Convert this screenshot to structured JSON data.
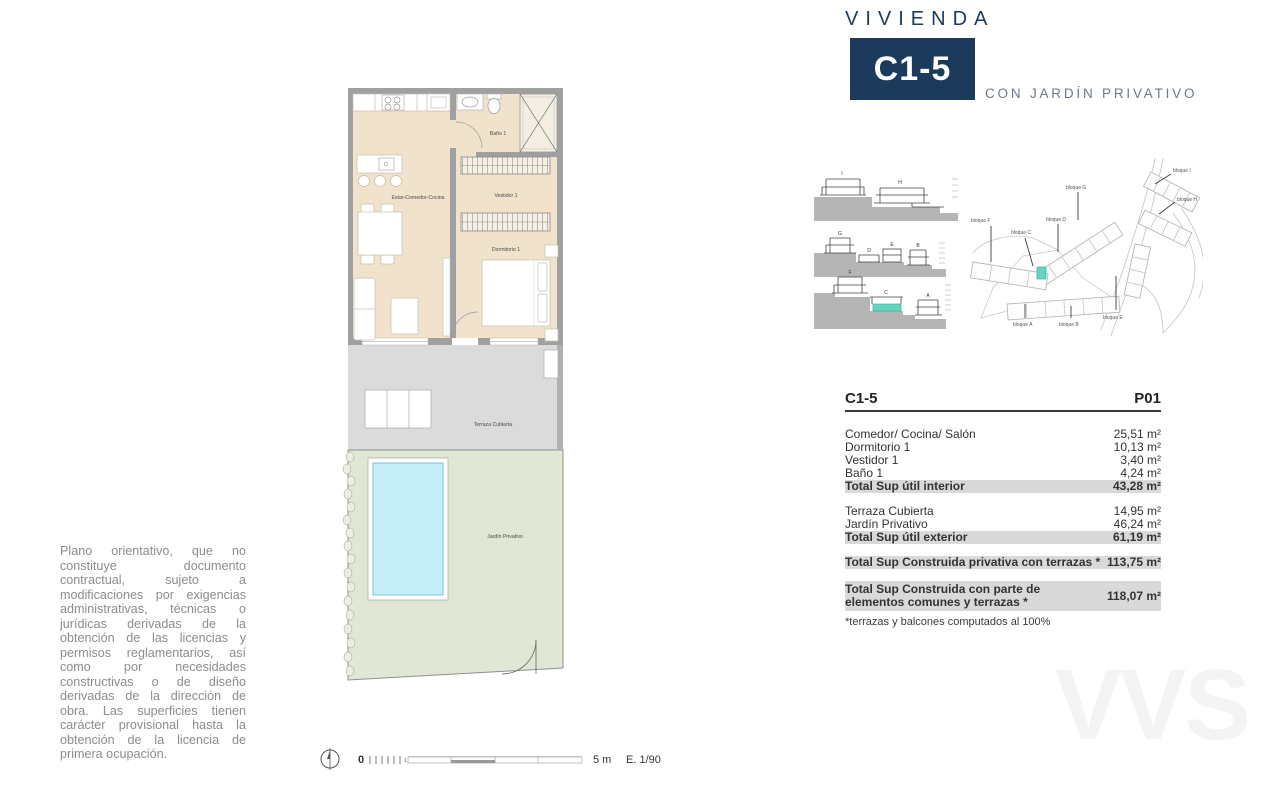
{
  "header": {
    "kicker": "VIVIENDA",
    "unit": "C1-5",
    "subtitle": "CON JARDÍN PRIVATIVO"
  },
  "plan": {
    "labels": {
      "estar": "Estar-Comedor-Cocina",
      "bano": "Baño 1",
      "vestidor": "Vestidor 1",
      "dormitorio": "Dormitorio 1",
      "terraza": "Terraza Cubierta",
      "jardin": "Jardín Privativo"
    }
  },
  "sections": {
    "blocks": {
      "i": "I",
      "h": "H",
      "g": "G",
      "d": "D",
      "e": "E",
      "b": "B",
      "f": "F",
      "c": "C",
      "a": "A"
    },
    "highlight_block": "C"
  },
  "siteplan": {
    "labels": {
      "f": "bloque F",
      "c": "bloque C",
      "g": "bloque G",
      "d": "bloque D",
      "i": "bloque I",
      "h": "bloque H",
      "a": "bloque A",
      "b": "bloque B",
      "e": "bloque E"
    }
  },
  "table": {
    "unit": "C1-5",
    "floor": "P01",
    "rows": [
      {
        "label": "Comedor/ Cocina/ Salón",
        "value": "25,51 m²"
      },
      {
        "label": "Dormitorio 1",
        "value": "10,13 m²"
      },
      {
        "label": "Vestidor 1",
        "value": "3,40 m²"
      },
      {
        "label": "Baño 1",
        "value": "4,24 m²"
      },
      {
        "label": "Total Sup útil interior",
        "value": "43,28 m²"
      },
      {
        "label": "Terraza Cubierta",
        "value": "14,95 m²"
      },
      {
        "label": "Jardín Privativo",
        "value": "46,24 m²"
      },
      {
        "label": "Total Sup útil exterior",
        "value": "61,19 m²"
      },
      {
        "label": "Total Sup Construida privativa con terrazas *",
        "value": "113,75 m²"
      },
      {
        "label": "Total Sup Construida con parte de elementos comunes y terrazas *",
        "value": "118,07 m²"
      }
    ],
    "footnote": "*terrazas y balcones computados al 100%"
  },
  "disclaimer": "Plano orientativo, que no constituye documento contractual, sujeto a modificaciones por exigencias administrativas, técnicas o jurídicas derivadas de la obtención de las licencias y permisos reglamentarios, así como por necesidades constructivas o de diseño derivadas de la dirección de obra. Las superficies tienen carácter provisional hasta la obtención de la licencia de primera ocupación.",
  "scalebar": {
    "zero": "0",
    "one_meter": "1 m",
    "five_meters": "5 m",
    "scale": "E. 1/90"
  },
  "watermark": "VVS",
  "colors": {
    "navy": "#1c3a5c",
    "subtitle_gray": "#6d7988",
    "floor_beige": "#f0e2cb",
    "wall_gray": "#a0a0a0",
    "terrace_gray": "#dbdbdb",
    "garden_green": "#e0e7d4",
    "pool_cyan": "#c6eff9",
    "unit_highlight_teal": "#63d6c0",
    "table_row_gray": "#d9d9d9"
  }
}
